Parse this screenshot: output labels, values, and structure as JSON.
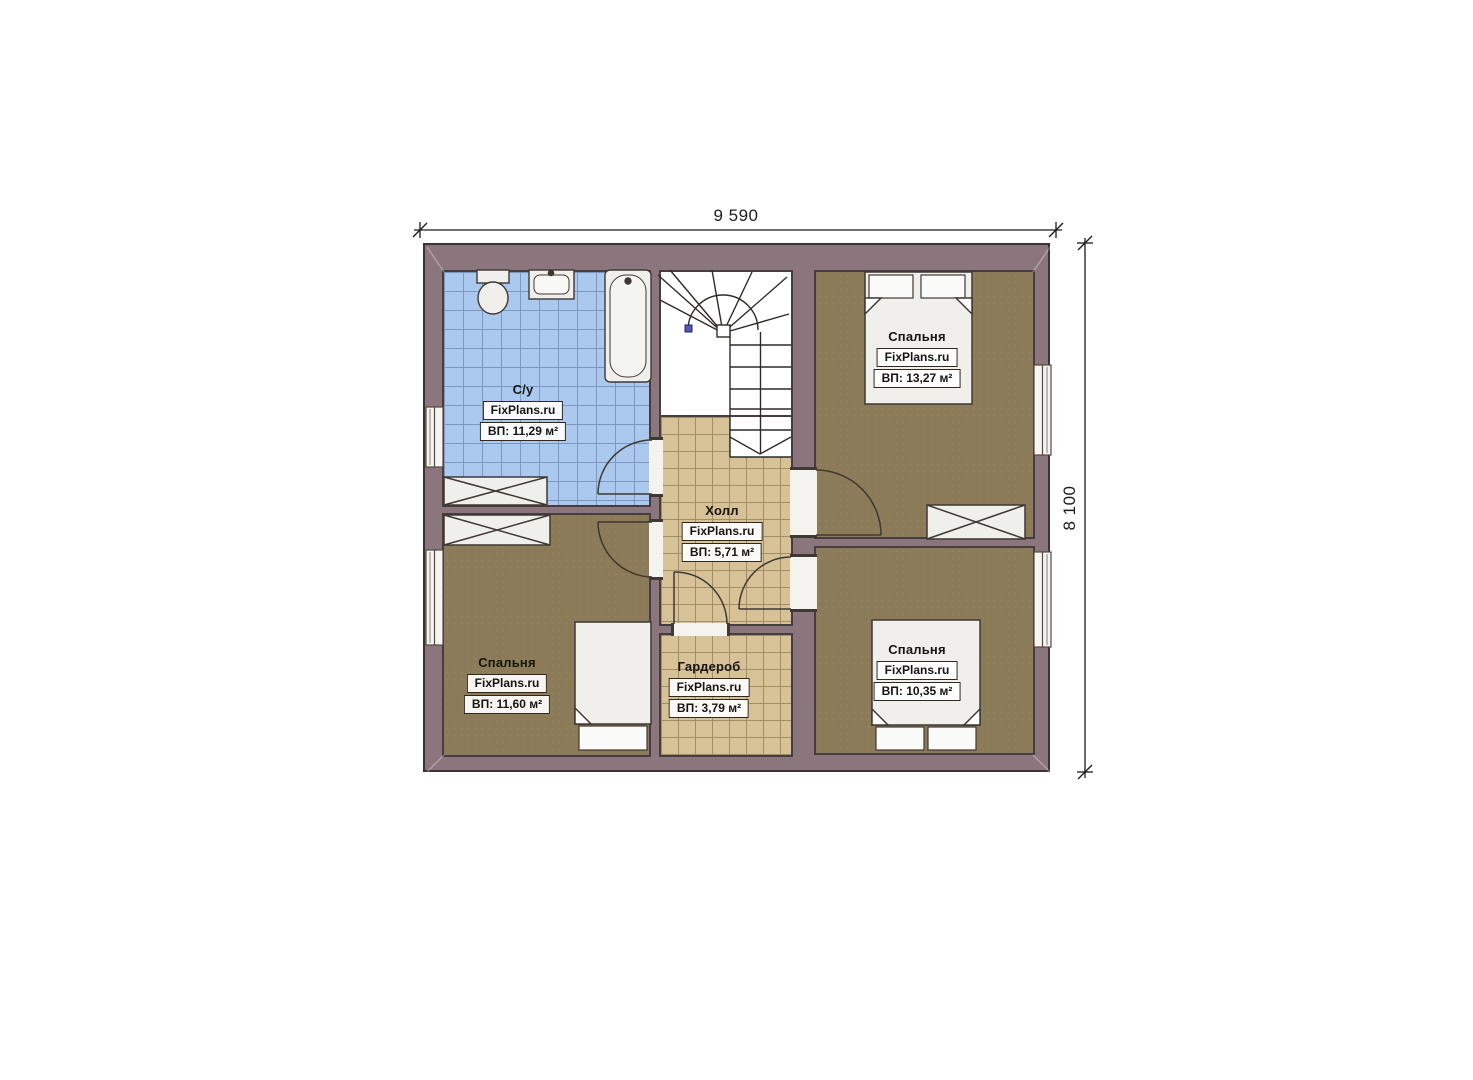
{
  "brand": "FixPlans.ru",
  "dimensions": {
    "top": "9 590",
    "right": "8 100"
  },
  "rooms": {
    "bathroom": {
      "name": "С/у",
      "area": "ВП: 11,29 м²"
    },
    "bedroom_top_right": {
      "name": "Спальня",
      "area": "ВП: 13,27 м²"
    },
    "hall": {
      "name": "Холл",
      "area": "ВП: 5,71 м²"
    },
    "bedroom_left": {
      "name": "Спальня",
      "area": "ВП: 11,60 м²"
    },
    "wardrobe": {
      "name": "Гардероб",
      "area": "ВП: 3,79 м²"
    },
    "bedroom_bottom_right": {
      "name": "Спальня",
      "area": "ВП: 10,35 м²"
    }
  },
  "colors": {
    "wall": "#8c767d",
    "wall_outline": "#3b3338",
    "bathroom_tile": "#abc9ee",
    "hall_tile": "#d7c197",
    "bedroom_floor": "#8b7b58",
    "stair_marker": "#5358c0",
    "label_border": "#30281c"
  }
}
